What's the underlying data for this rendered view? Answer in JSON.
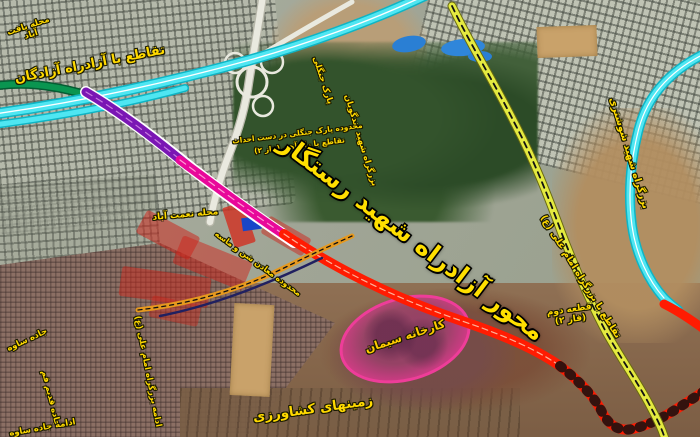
{
  "map": {
    "title": "نقشه ماهواره‌ای محور آزادراه شهید رستگار",
    "type": "annotated satellite map with highway project overlays",
    "language": "fa"
  },
  "labels": [
    {
      "id": "neighborhood-northwest",
      "text": "محله یافت آباد"
    },
    {
      "id": "azadegan-interchange",
      "text": "تقاطع با آزادراه آزادگان"
    },
    {
      "id": "forest-park",
      "text": "پارک جنگلی"
    },
    {
      "id": "tondguyan-highway",
      "text": "بزرگراه شهید تندگویان"
    },
    {
      "id": "park-under-construction",
      "text": "محدوده پارک جنگلی در دست احداث"
    },
    {
      "id": "railway-crossing",
      "text": "تقاطع با راه آهن (فاز ۲)"
    },
    {
      "id": "main-axis-title",
      "text": "محور آزادراه شهید رستگار"
    },
    {
      "id": "shooshtari-highway",
      "text": "بزرگراه شهید شوشتری"
    },
    {
      "id": "imam-ali-interchange",
      "text": "تقاطع با بزرگراه امام علی (ع)"
    },
    {
      "id": "section-phase",
      "text": "قطعه دوم (فاز ۲)"
    },
    {
      "id": "cement-factory",
      "text": "کارخانه سیمان"
    },
    {
      "id": "agricultural-lands",
      "text": "زمینهای کشاورزی"
    },
    {
      "id": "nematabad-neighborhood",
      "text": "محله نعمت آباد"
    },
    {
      "id": "imam-ali-extension",
      "text": "ادامه بزرگراه امام علی (ع)"
    },
    {
      "id": "sand-gravel-mines",
      "text": "محدوده معادن شن و ماسه"
    },
    {
      "id": "saveh-road",
      "text": "جاده ساوه"
    },
    {
      "id": "old-qom-road",
      "text": "جاده قدیم قم"
    },
    {
      "id": "saveh-road-continue",
      "text": "ادامه جاده ساوه"
    }
  ],
  "roads": [
    {
      "name": "azadegan-freeway",
      "color": "#4fe6f2"
    },
    {
      "name": "green-connector",
      "color": "#0a9550"
    },
    {
      "name": "project-axis-purple-segment",
      "color": "#7a16b4"
    },
    {
      "name": "project-axis-magenta-segment",
      "color": "#e8089a"
    },
    {
      "name": "project-axis-red-segment",
      "color": "#ff1c02"
    },
    {
      "name": "shooshtari-highway",
      "color": "#4fe6f2"
    },
    {
      "name": "imam-ali-highway",
      "color": "#e4ea40"
    },
    {
      "name": "interchange-ramps",
      "color": "#e9e9df"
    },
    {
      "name": "minor-orange-road",
      "color": "#e6991e"
    },
    {
      "name": "navy-utility-line",
      "color": "#202060"
    }
  ],
  "areas": [
    {
      "name": "cement-factory-highlight",
      "color": "#ee3d99"
    },
    {
      "name": "censored-block-north",
      "color": "#c9a26a"
    },
    {
      "name": "censored-block-south",
      "color": "#c9a26a"
    },
    {
      "name": "demolition-zones",
      "color": "#cd2319"
    },
    {
      "name": "forest-park-area",
      "color": "#2c4b27"
    },
    {
      "name": "agricultural-terrain",
      "color": "#84654a"
    }
  ],
  "colors": {
    "label_yellow": "#ffd900",
    "title_yellow": "#ffdf00",
    "cyan_highway": "#4fe6f2",
    "magenta_axis": "#e8089a",
    "red_axis": "#ff1c02",
    "yellow_highway": "#e4ea40",
    "pink_highlight": "#ee3d99"
  }
}
